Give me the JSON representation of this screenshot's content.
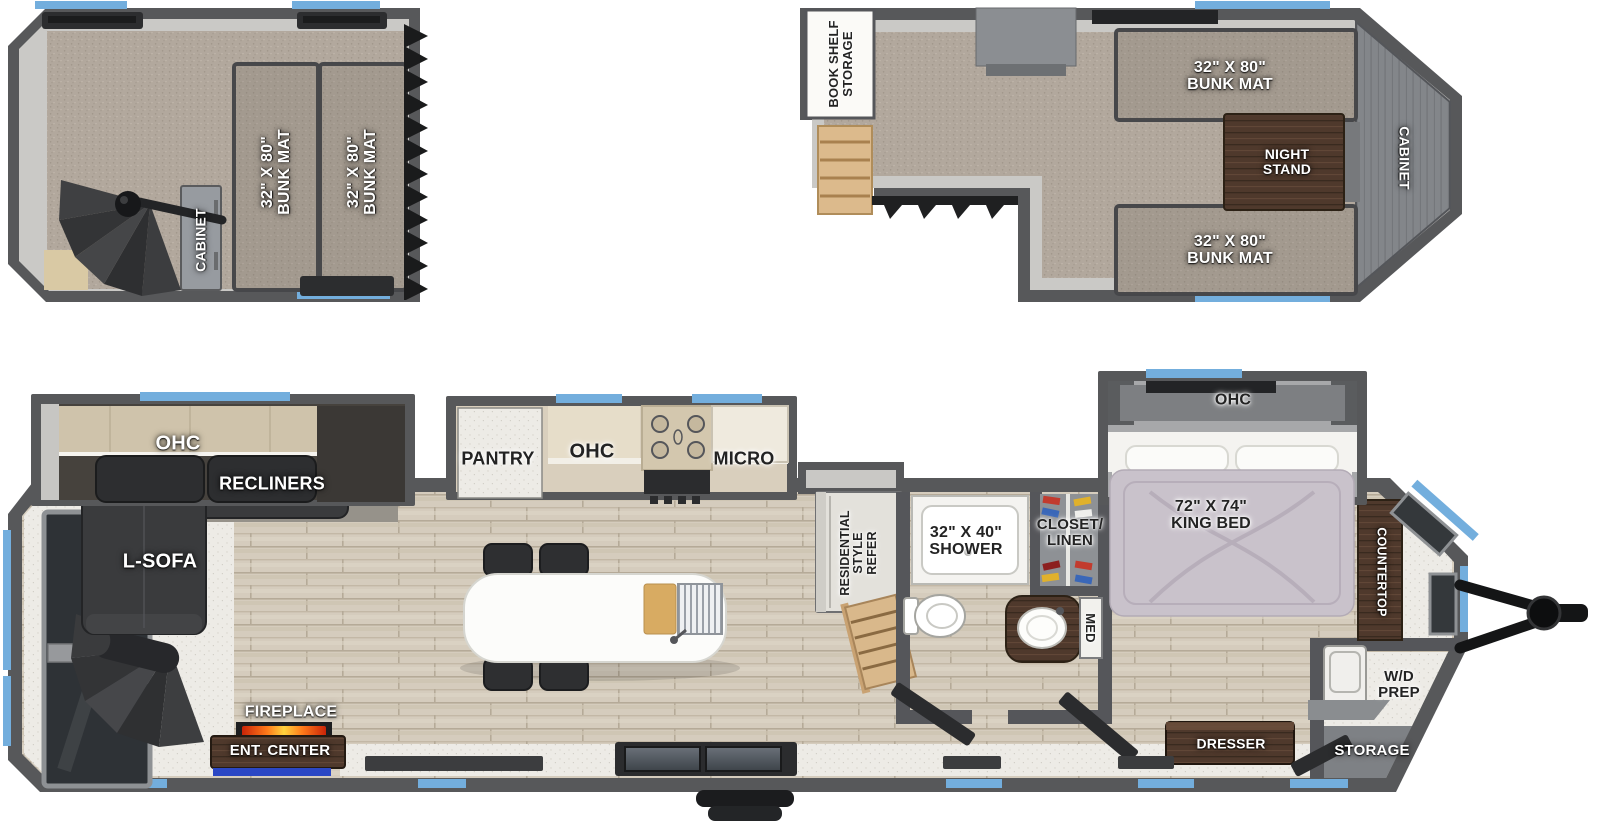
{
  "colors": {
    "wall": "#57585a",
    "wall_inner": "#cac9c6",
    "accent_window_blue": "#73aedd",
    "carpet": "#b2a89d",
    "wood_floor": "#d5ccbd",
    "dark_wood": "#50392b",
    "ent_center_accent_blue": "#2b47c4",
    "fireplace_flame_orange": "#ff7a1a"
  },
  "rear_loft": {
    "bunk_mat_left": "32\" X 80\"\nBUNK MAT",
    "bunk_mat_right": "32\" X 80\"\nBUNK MAT",
    "cabinet": "CABINET"
  },
  "front_loft": {
    "book_shelf_storage": "BOOK SHELF\nSTORAGE",
    "bunk_mat_top": "32\" X 80\"\nBUNK MAT",
    "night_stand": "NIGHT\nSTAND",
    "bunk_mat_bottom": "32\" X 80\"\nBUNK MAT",
    "cabinet": "CABINET"
  },
  "main_floor": {
    "ohc_living": "OHC",
    "recliners": "RECLINERS",
    "l_sofa": "L-SOFA",
    "fireplace": "FIREPLACE",
    "ent_center": "ENT. CENTER",
    "pantry": "PANTRY",
    "ohc_kitchen": "OHC",
    "micro": "MICRO",
    "refrigerator": "RESIDENTIAL\nSTYLE\nREFER",
    "shower": "32\" X 40\"\nSHOWER",
    "closet_linen": "CLOSET/\nLINEN",
    "med_cabinet": "MED",
    "king_bed": "72\" X 74\"\nKING BED",
    "ohc_bedroom": "OHC",
    "countertop": "COUNTERTOP",
    "wd_prep": "W/D\nPREP",
    "dresser": "DRESSER",
    "storage": "STORAGE"
  }
}
